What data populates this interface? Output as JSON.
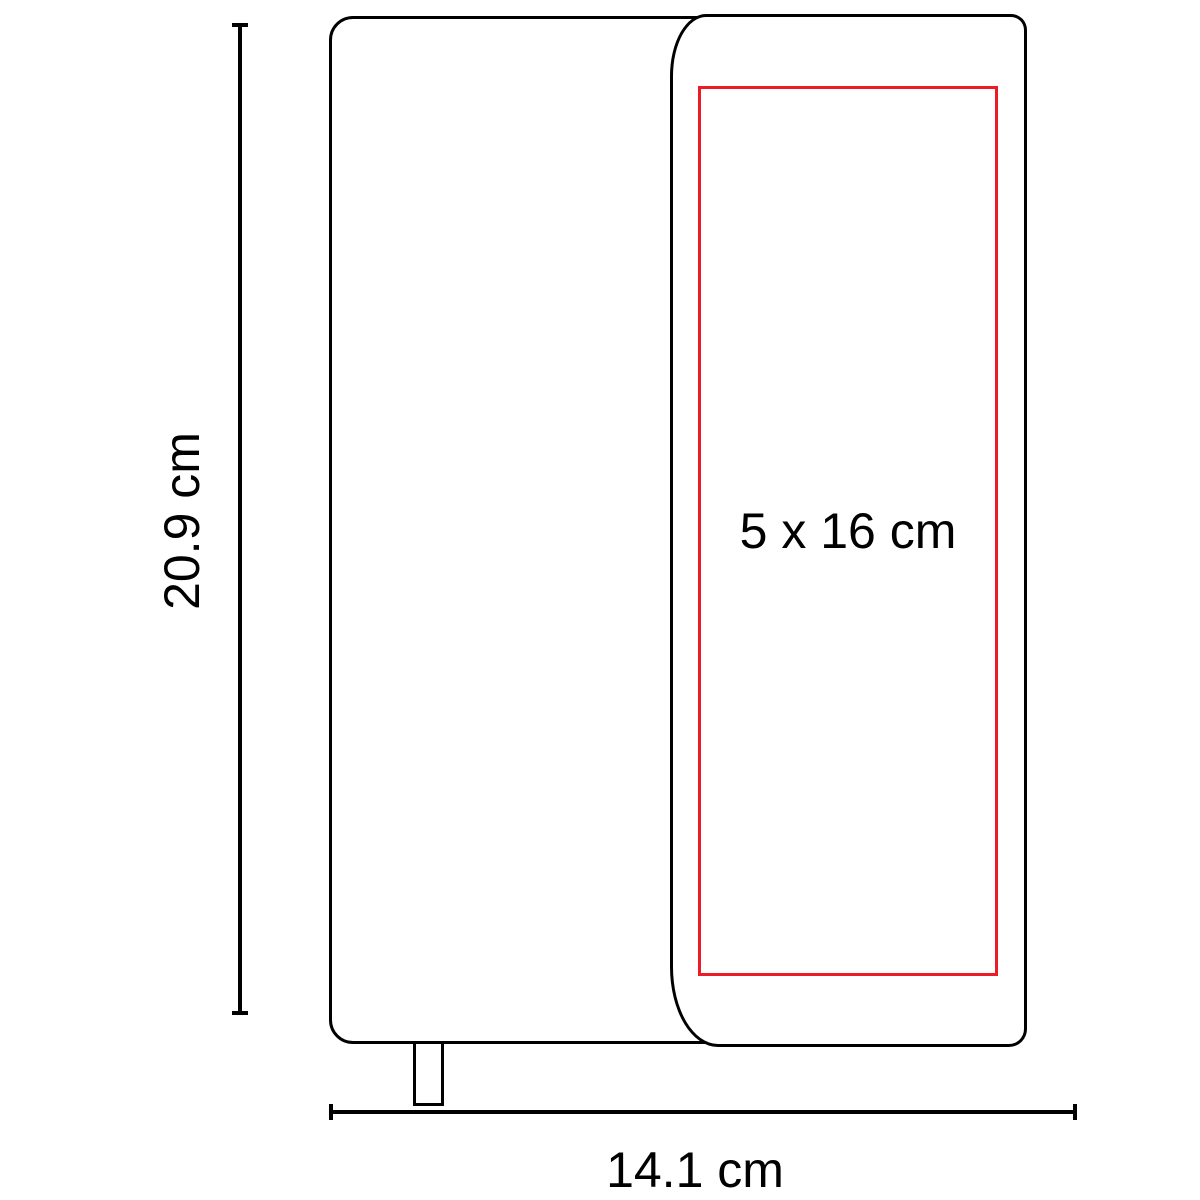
{
  "page": {
    "background": "#ffffff"
  },
  "diagram": {
    "description": "notebook-with-cover-flap-dimension-diagram",
    "outline_color": "#000000",
    "dimensions": {
      "height": {
        "label": "20.9 cm"
      },
      "width": {
        "label": "14.1 cm"
      }
    },
    "print_area": {
      "label": "5 x 16 cm",
      "border_color": "#ed1c24"
    }
  }
}
